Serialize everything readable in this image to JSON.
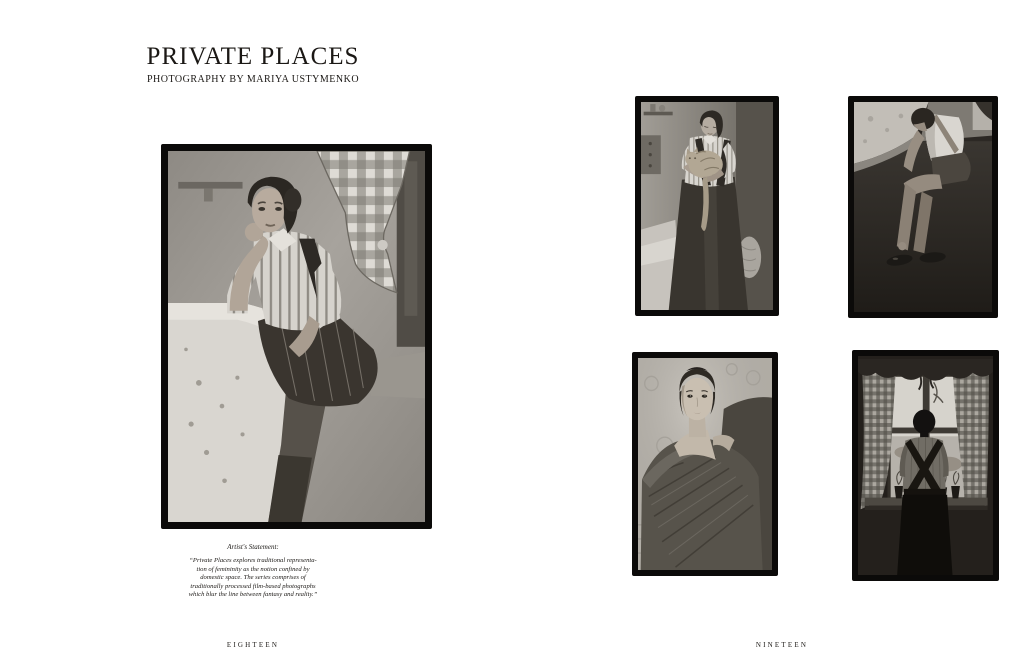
{
  "colors": {
    "paper": "#ffffff",
    "ink": "#1b1815",
    "frame": "#0b0a09"
  },
  "article": {
    "title": "PRIVATE PLACES",
    "byline": "PHOTOGRAPHY BY MARIYA USTYMENKO"
  },
  "statement": {
    "heading": "Artist's Statement:",
    "body": "“Private Places explores traditional representa-\ntion of femininity as the notion confined by\ndomestic space. The series comprises of\ntraditionally processed film-based photographs\nwhich blur the line between fantasy and reality.”"
  },
  "folios": {
    "left": "EIGHTEEN",
    "right": "NINETEEN"
  },
  "photos": [
    {
      "id": "woman-at-table",
      "alt": "Black-and-white photograph of a woman in a striped shirt, suspender pinafore and pinstriped skirt seated at a table with an embroidered cloth, resting her head on her hand beside a tied-back gingham curtain"
    },
    {
      "id": "woman-holding-cat",
      "alt": "Black-and-white photograph of a woman in a striped shirt and dark pinafore cradling a tabby cat in a kitchen with shelves behind her"
    },
    {
      "id": "woman-fastening-shoe",
      "alt": "Black-and-white photograph of a woman seated in a dark corner bending down to fasten the strap of her flat shoe"
    },
    {
      "id": "portrait-in-shawl",
      "alt": "Black-and-white portrait of a woman with bare shoulders wrapped in a woven shawl, gazing directly at the camera against patterned wallpaper"
    },
    {
      "id": "woman-at-window",
      "alt": "Black-and-white photograph of a woman with crossed suspenders seen from behind, standing at a bright window with gingham curtains, a scalloped valance and potted plants on the sill"
    }
  ]
}
